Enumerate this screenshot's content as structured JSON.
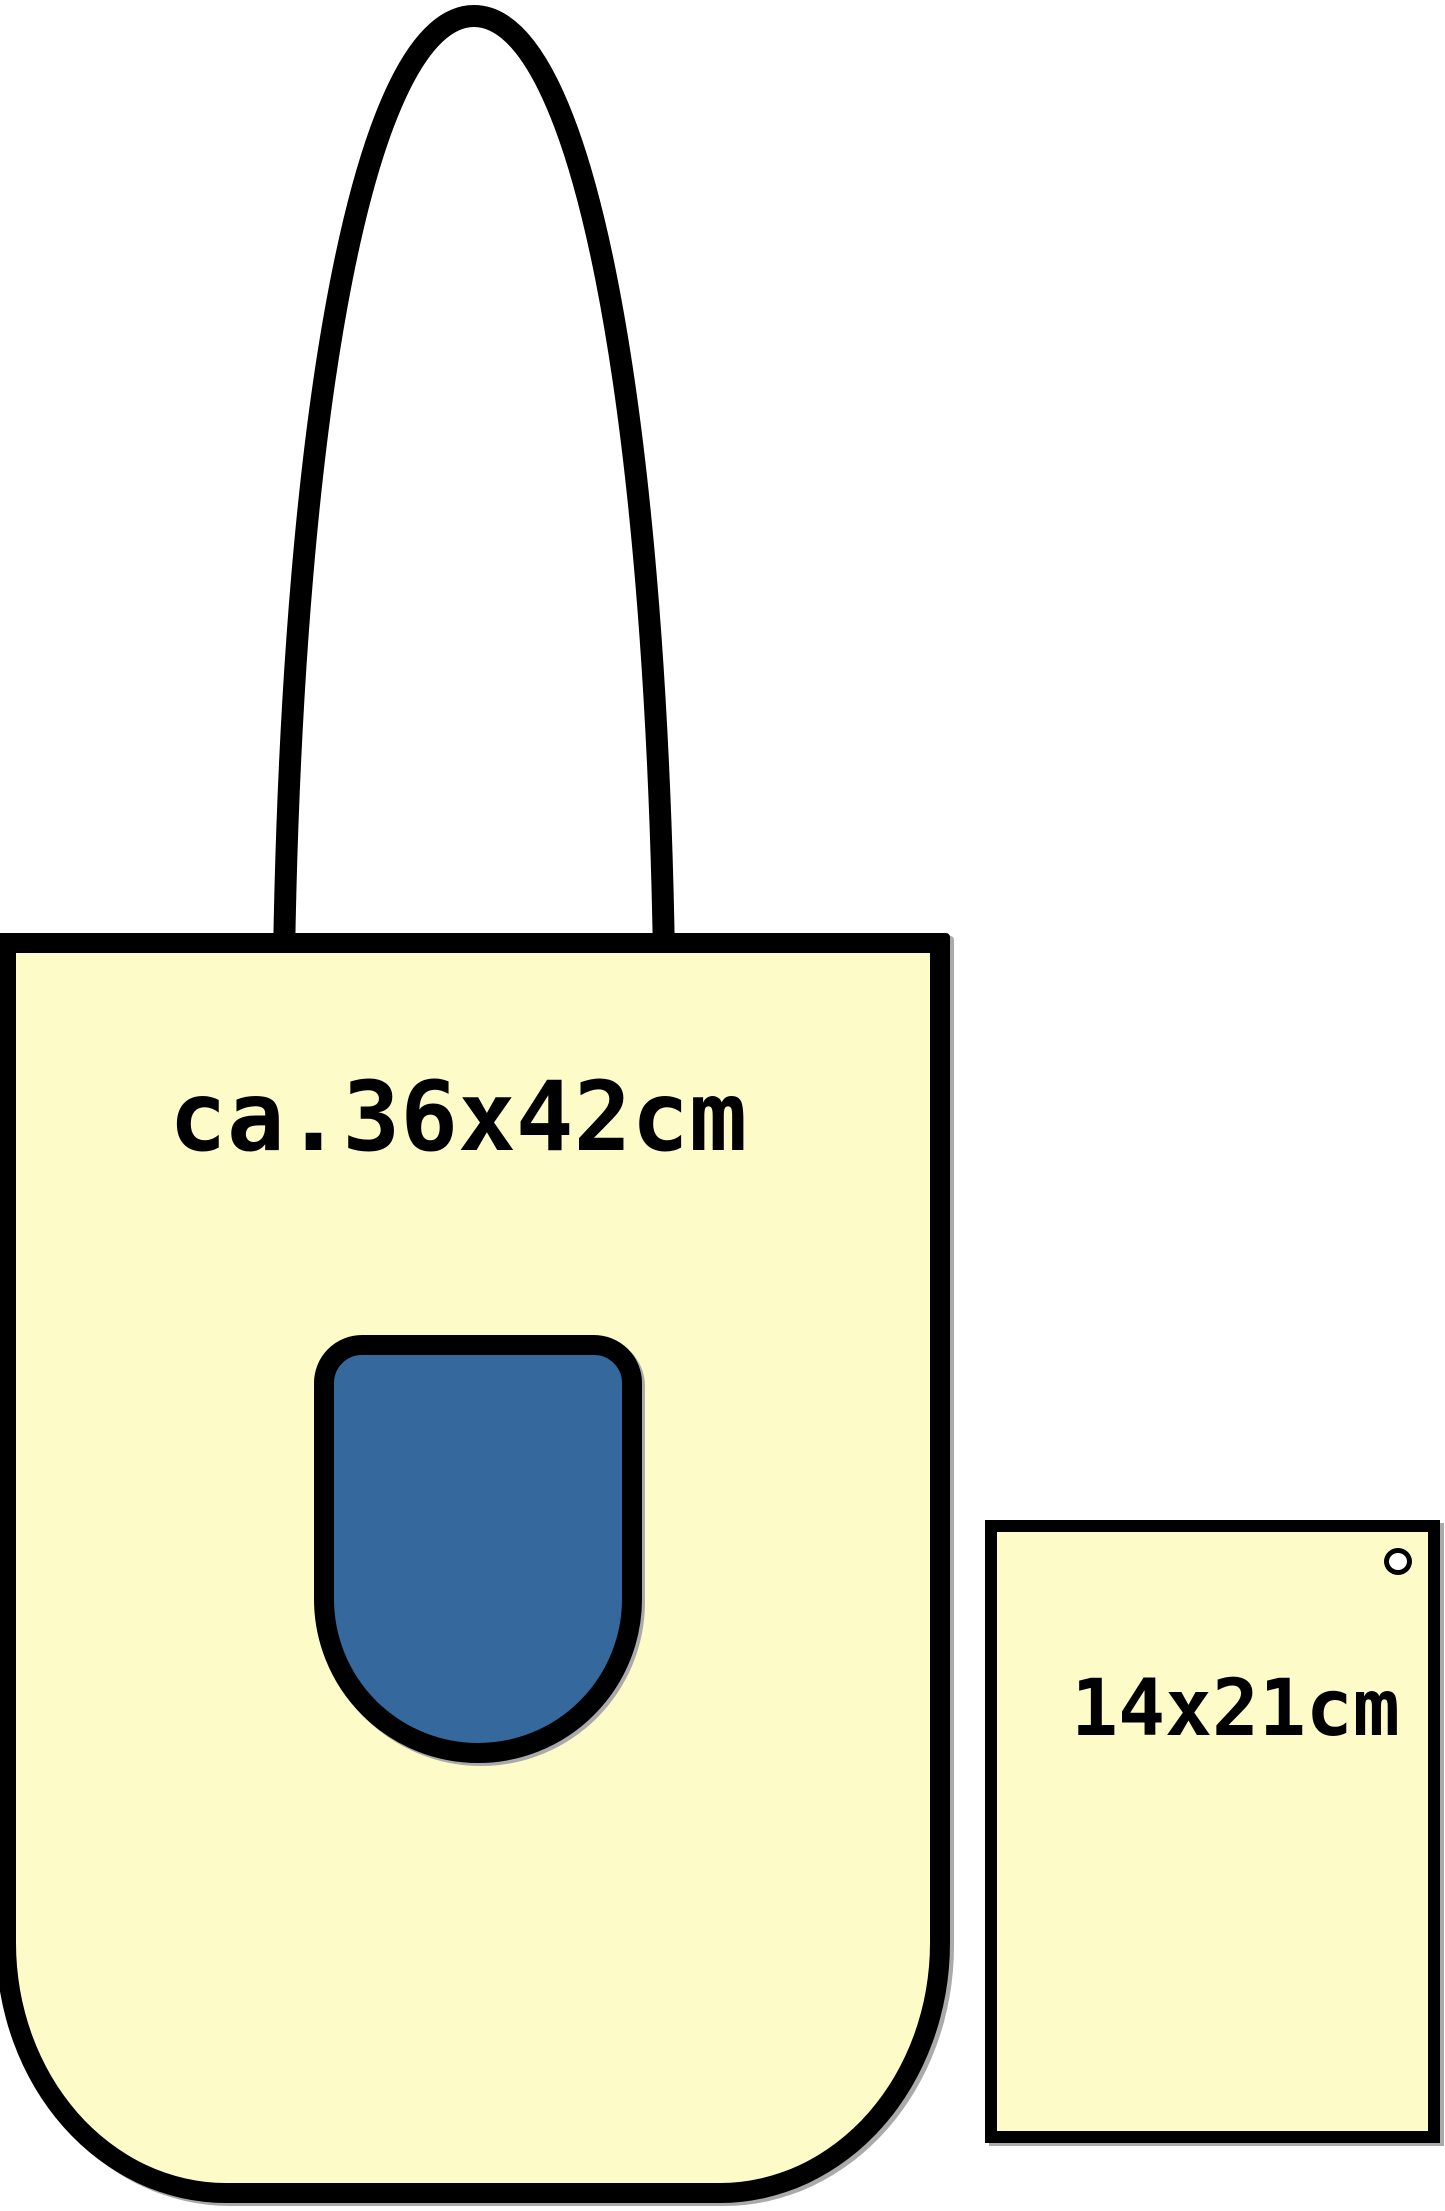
{
  "diagram": {
    "bag": {
      "size_label": "ca.36x42cm"
    },
    "flyer": {
      "size_label": "14x21cm"
    }
  },
  "colors": {
    "background": "#FFFFFF",
    "cream": "#FDFBC8",
    "blue": "#35689C",
    "outline": "#000000",
    "shadow": "#AAAAAA"
  }
}
